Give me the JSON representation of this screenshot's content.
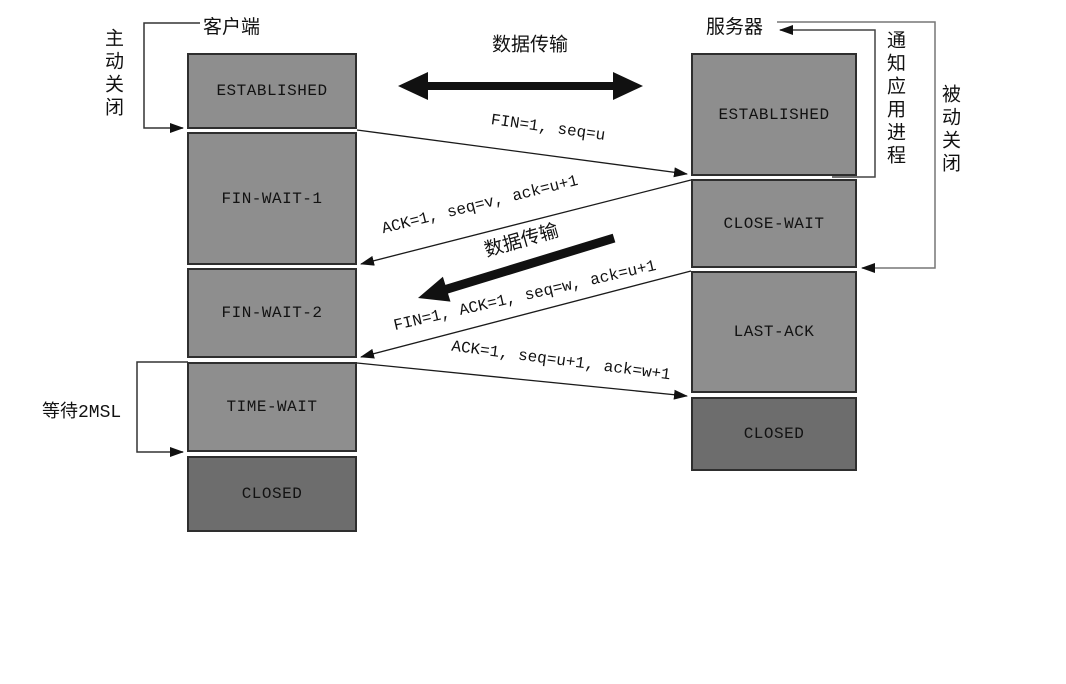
{
  "client": {
    "label": "客户端",
    "close_label": "主动关闭",
    "wait_label": "等待2MSL",
    "states": [
      "ESTABLISHED",
      "FIN-WAIT-1",
      "FIN-WAIT-2",
      "TIME-WAIT",
      "CLOSED"
    ]
  },
  "server": {
    "label": "服务器",
    "close_label": "被动关闭",
    "notify_label": "通知应用进程",
    "states": [
      "ESTABLISHED",
      "CLOSE-WAIT",
      "LAST-ACK",
      "CLOSED"
    ]
  },
  "messages": {
    "fin": "FIN=1, seq=u",
    "ack": "ACK=1, seq=v, ack=u+1",
    "fin_ack": "FIN=1, ACK=1, seq=w, ack=u+1",
    "last_ack": "ACK=1, seq=u+1, ack=w+1"
  },
  "data_transfer": {
    "top_label": "数据传输",
    "middle_label": "数据传输"
  },
  "colors": {
    "state_fill": "#8e8e8e",
    "closed_fill": "#6d6d6d",
    "line": "#1a1a1a"
  }
}
